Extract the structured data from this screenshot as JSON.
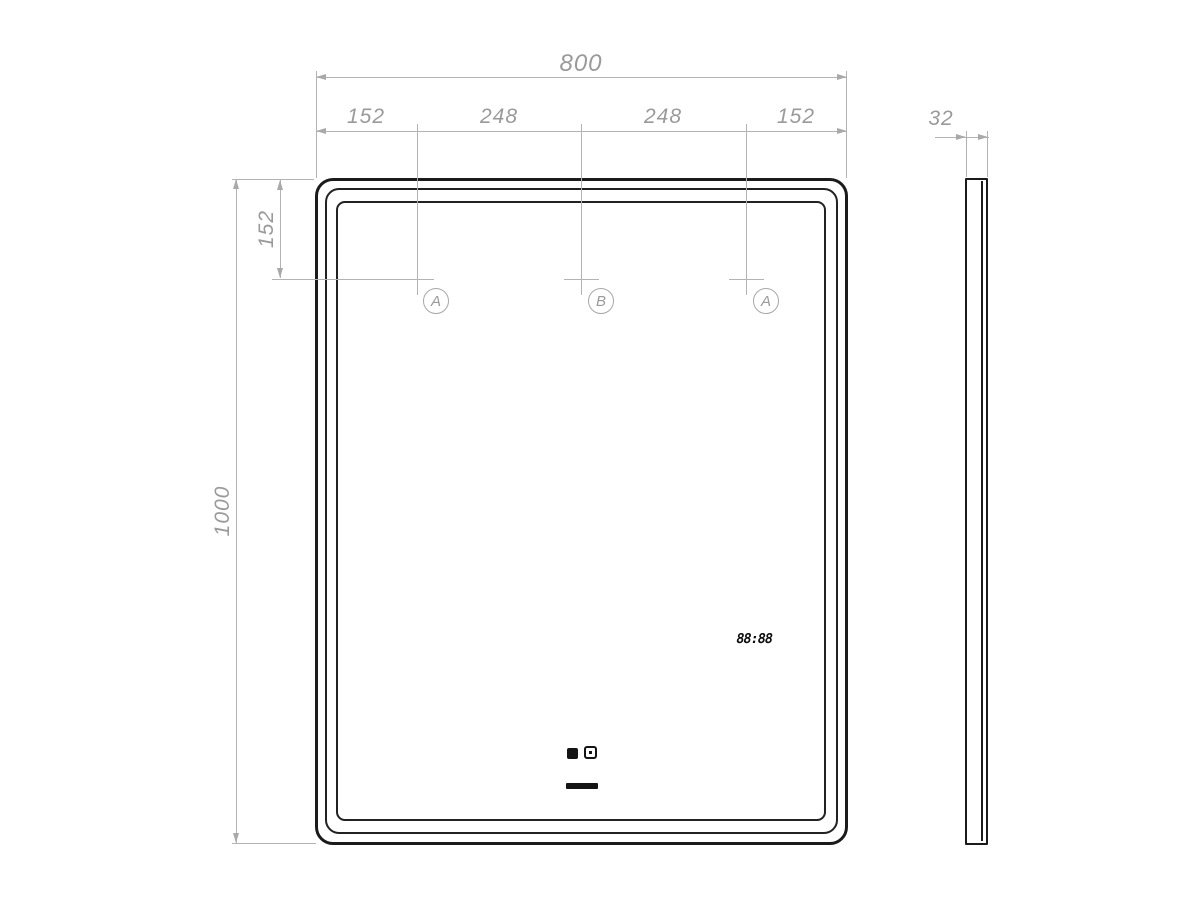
{
  "drawing": {
    "front_view": {
      "width_total": "800",
      "segments": [
        "152",
        "248",
        "248",
        "152"
      ],
      "top_offset": "152",
      "height_total": "1000",
      "mounts": [
        {
          "label": "A"
        },
        {
          "label": "B"
        },
        {
          "label": "A"
        }
      ],
      "clock_display": "88:88"
    },
    "side_view": {
      "thickness": "32"
    },
    "icons": [
      "clock-set-sensor-icon",
      "power-sensor-icon",
      "touch-slider-bar"
    ],
    "colors": {
      "outline": "#1b1b1b",
      "dimension_line": "#b3b3b3",
      "dimension_text": "#9a9a9c",
      "display_ink": "#0d0d0d",
      "background": "#ffffff"
    }
  }
}
